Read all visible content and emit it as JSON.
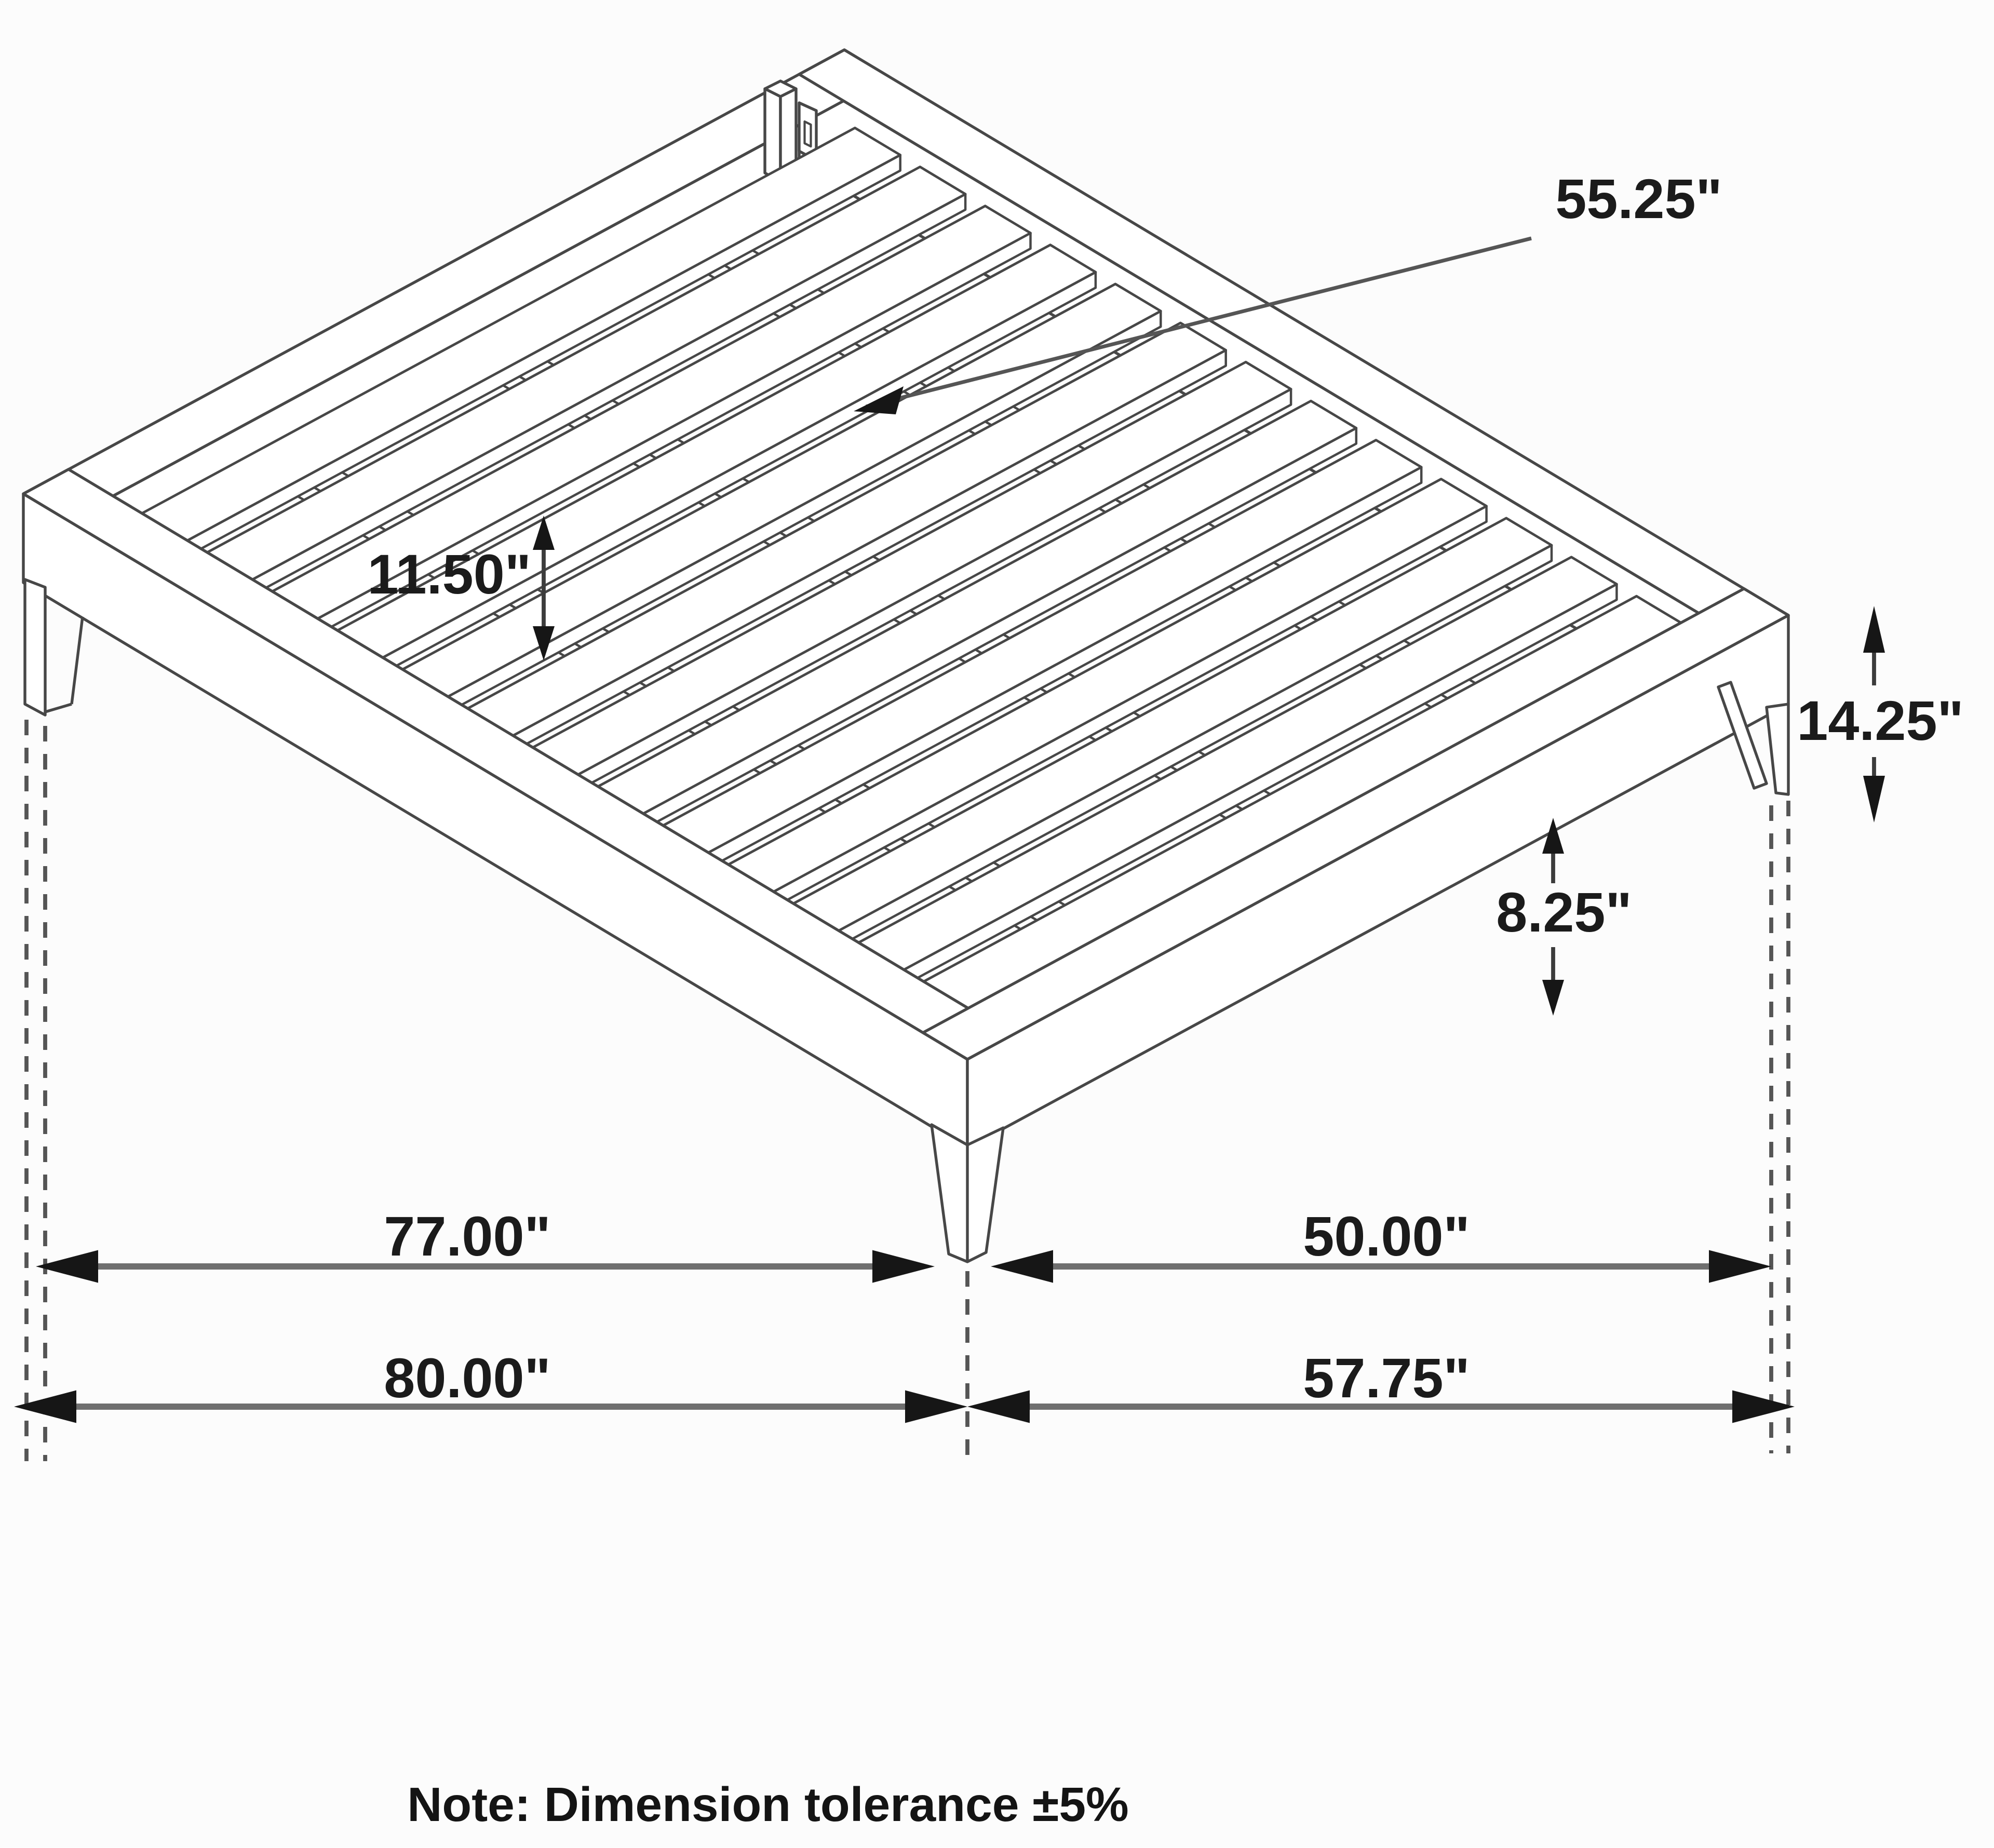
{
  "drawing": {
    "subject": "platform bed frame - isometric technical drawing",
    "slat_count": 13,
    "support_rail_count": 3,
    "leg_count": 4
  },
  "dimensions": {
    "slat_length": "55.25\"",
    "slat_spacing": "11.50\"",
    "overall_height": "14.25\"",
    "under_clearance": "8.25\"",
    "inner_length": "77.00\"",
    "inner_width": "50.00\"",
    "overall_length": "80.00\"",
    "overall_width": "57.75\""
  },
  "note": "Note: Dimension tolerance ±5%",
  "colors": {
    "background": "#fcfcfc",
    "face": "#ffffff",
    "line": "#474747",
    "dim_line": "#6f6f6f",
    "thin_dim": "#3c3c3c",
    "arrow": "#161616",
    "text": "#1b1b1b",
    "dash": "#555555"
  }
}
